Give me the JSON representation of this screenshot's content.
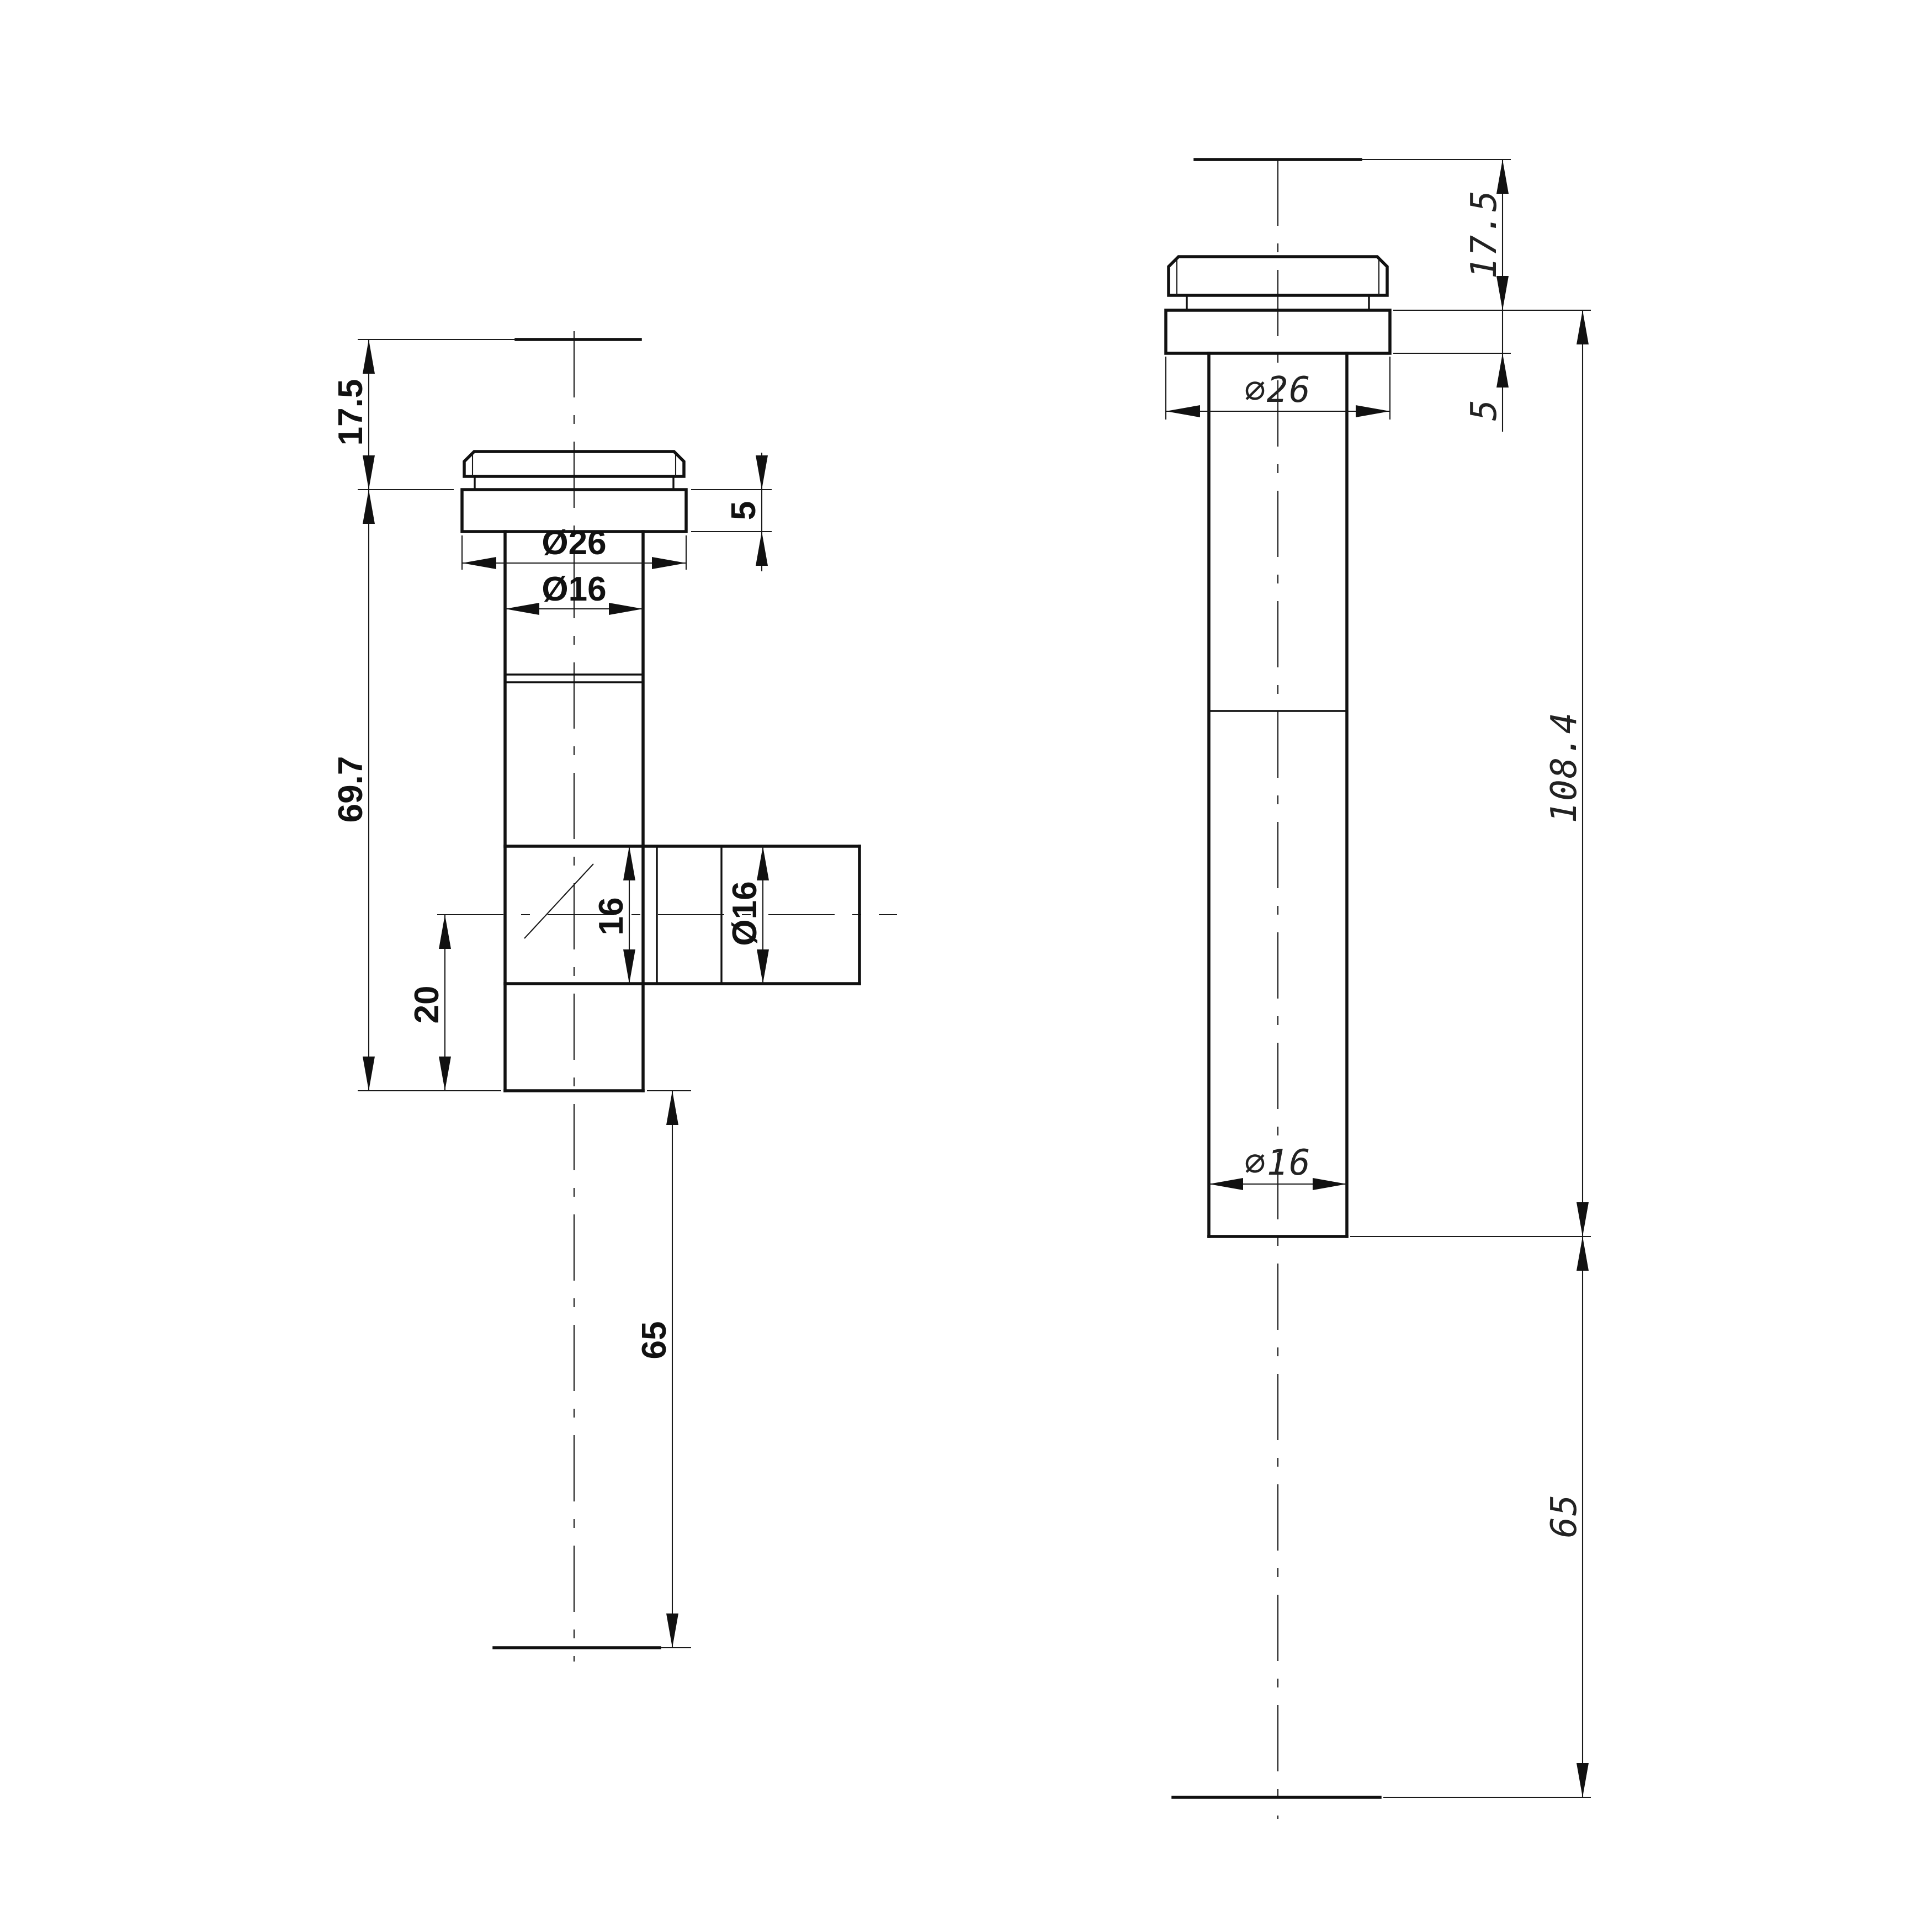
{
  "drawing": {
    "background": "#ffffff",
    "line_color": "#111111",
    "left_view": {
      "description": "tee-fitting-side-view",
      "dim_17_5": "17.5",
      "dim_69_7": "69.7",
      "dim_20": "20",
      "dim_65": "65",
      "dim_5": "5",
      "dim_dia26": "Ø26",
      "dim_dia16": "Ø16",
      "dim_arm_16": "16",
      "dim_arm_dia16": "Ø16"
    },
    "right_view": {
      "description": "straight-fitting-side-view",
      "dim_17_5": "17.5",
      "dim_5": "5",
      "dim_dia26": "∅26",
      "dim_108_4": "108.4",
      "dim_dia16": "∅16",
      "dim_65": "65"
    }
  }
}
